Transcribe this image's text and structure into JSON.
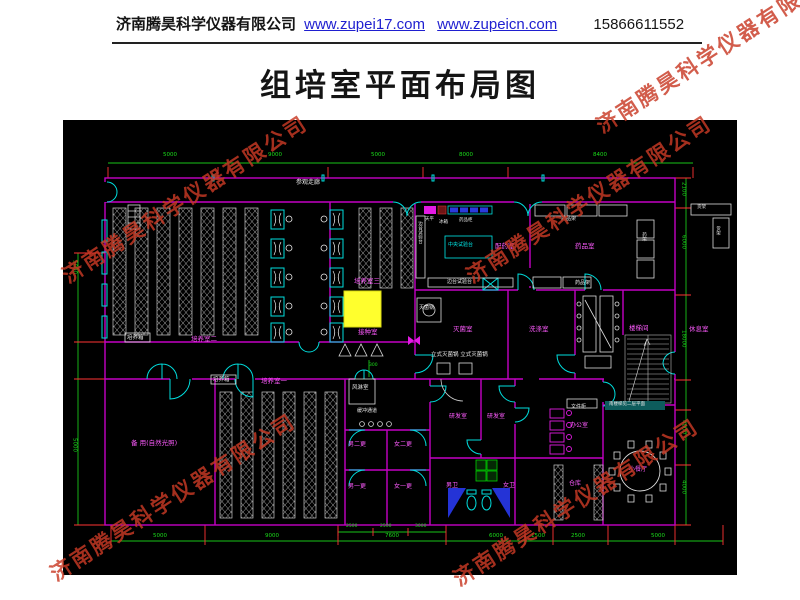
{
  "header": {
    "company": "济南腾昊科学仪器有限公司",
    "url1": "www.zupei17.com",
    "url2": "www.zupeicn.com",
    "phone": "15866611552"
  },
  "title": "组培室平面布局图",
  "watermark": {
    "text": "济南腾昊科学仪器有限公司"
  },
  "colors": {
    "wall": "#c400c4",
    "dimension": "#1ade1a",
    "tick": "#ff3333",
    "door": "#00dede",
    "highlight": "#ffff2d",
    "room_label": "#ff5bff",
    "equipment_label": "#e9e9e9",
    "watermark": "#c93a25",
    "link": "#1f1fd0"
  },
  "drawing": {
    "labels": [
      {
        "t": "参观走廊",
        "x": 233,
        "y": 60,
        "c": "w",
        "s": 6,
        "n": "label-visitor-corridor"
      },
      {
        "t": "培养箱",
        "x": 64,
        "y": 216,
        "c": "w",
        "s": 5.5,
        "n": "label-incubator"
      },
      {
        "t": "培养室二",
        "x": 128,
        "y": 216,
        "c": "m",
        "s": 6.5,
        "n": "label-culture-room-2"
      },
      {
        "t": "培养室三",
        "x": 291,
        "y": 158,
        "c": "m",
        "s": 6.5,
        "n": "label-culture-room-3"
      },
      {
        "t": "接种室",
        "x": 295,
        "y": 209,
        "c": "m",
        "s": 6.5,
        "n": "label-inoculation-room"
      },
      {
        "t": "培养箱",
        "x": 150,
        "y": 258,
        "c": "w",
        "s": 5.5,
        "n": "label-incubator"
      },
      {
        "t": "培养室一",
        "x": 198,
        "y": 258,
        "c": "m",
        "s": 6.5,
        "n": "label-culture-room-1"
      },
      {
        "t": "备 用(自然光照)",
        "x": 68,
        "y": 320,
        "c": "m",
        "s": 6.5,
        "n": "label-spare-room"
      },
      {
        "t": "风淋室",
        "x": 289,
        "y": 266,
        "c": "w",
        "s": 5.5,
        "n": "label-air-shower"
      },
      {
        "t": "缓冲通道",
        "x": 294,
        "y": 289,
        "c": "w",
        "s": 5,
        "n": "label-buffer-corridor"
      },
      {
        "t": "男二更",
        "x": 285,
        "y": 322,
        "c": "m",
        "s": 6,
        "n": "label-change-room"
      },
      {
        "t": "女二更",
        "x": 331,
        "y": 322,
        "c": "m",
        "s": 6,
        "n": "label-change-room"
      },
      {
        "t": "男一更",
        "x": 285,
        "y": 364,
        "c": "m",
        "s": 6,
        "n": "label-change-room"
      },
      {
        "t": "女一更",
        "x": 331,
        "y": 364,
        "c": "m",
        "s": 6,
        "n": "label-change-room"
      },
      {
        "t": "灭菌锅",
        "x": 356,
        "y": 186,
        "c": "w",
        "s": 5,
        "n": "label-sterilizer"
      },
      {
        "t": "灭菌室",
        "x": 390,
        "y": 206,
        "c": "m",
        "s": 6.5,
        "n": "label-sterilization-room"
      },
      {
        "t": "立式灭菌锅 立式灭菌锅",
        "x": 368,
        "y": 233,
        "c": "w",
        "s": 5.5,
        "n": "label-vertical-sterilizers"
      },
      {
        "t": "洗涤室",
        "x": 466,
        "y": 206,
        "c": "m",
        "s": 6.5,
        "n": "label-washing-room"
      },
      {
        "t": "配药室",
        "x": 432,
        "y": 123,
        "c": "m",
        "s": 6.5,
        "n": "label-medicine-prep-room"
      },
      {
        "t": "药品室",
        "x": 512,
        "y": 123,
        "c": "m",
        "s": 6.5,
        "n": "label-medicine-room"
      },
      {
        "t": "中央试验台",
        "x": 385,
        "y": 123,
        "c": "c",
        "s": 5,
        "n": "label-central-bench"
      },
      {
        "t": "边台试验台",
        "x": 354,
        "y": 101,
        "c": "w",
        "s": 4.5,
        "v": 1,
        "n": "label-side-bench"
      },
      {
        "t": "边台试验台",
        "x": 384,
        "y": 160,
        "c": "w",
        "s": 5,
        "n": "label-side-bench"
      },
      {
        "t": "天平",
        "x": 362,
        "y": 98,
        "c": "w",
        "s": 4.5,
        "n": "label-balance"
      },
      {
        "t": "冰箱",
        "x": 376,
        "y": 101,
        "c": "w",
        "s": 4.5,
        "n": "label-fridge"
      },
      {
        "t": "药品柜",
        "x": 396,
        "y": 99,
        "c": "w",
        "s": 4.5,
        "n": "label-medicine-cabinet"
      },
      {
        "t": "药品架",
        "x": 498,
        "y": 97,
        "c": "w",
        "s": 5,
        "n": "label-medicine-rack"
      },
      {
        "t": "药品架",
        "x": 512,
        "y": 161,
        "c": "w",
        "s": 5,
        "n": "label-medicine-rack"
      },
      {
        "t": "药架",
        "x": 578,
        "y": 112,
        "c": "w",
        "s": 4.5,
        "v": 1,
        "n": "label-rack"
      },
      {
        "t": "货架",
        "x": 634,
        "y": 86,
        "c": "w",
        "s": 4.5,
        "n": "label-shelf"
      },
      {
        "t": "货架",
        "x": 652,
        "y": 106,
        "c": "w",
        "s": 4.5,
        "v": 1,
        "n": "label-shelf"
      },
      {
        "t": "楼梯间",
        "x": 566,
        "y": 205,
        "c": "m",
        "s": 6.5,
        "n": "label-stairwell"
      },
      {
        "t": "休息室",
        "x": 626,
        "y": 206,
        "c": "m",
        "s": 6.5,
        "n": "label-rest-room"
      },
      {
        "t": "研发室",
        "x": 386,
        "y": 294,
        "c": "m",
        "s": 6,
        "n": "label-rd-room"
      },
      {
        "t": "研发室",
        "x": 424,
        "y": 294,
        "c": "m",
        "s": 6,
        "n": "label-rd-room"
      },
      {
        "t": "办公室",
        "x": 507,
        "y": 303,
        "c": "m",
        "s": 6,
        "n": "label-office"
      },
      {
        "t": "文件柜",
        "x": 508,
        "y": 285,
        "c": "w",
        "s": 5,
        "n": "label-file-cabinet"
      },
      {
        "t": "男卫",
        "x": 383,
        "y": 363,
        "c": "m",
        "s": 6,
        "n": "label-mens-toilet"
      },
      {
        "t": "女卫",
        "x": 440,
        "y": 363,
        "c": "m",
        "s": 6,
        "n": "label-womens-toilet"
      },
      {
        "t": "仓库",
        "x": 506,
        "y": 361,
        "c": "m",
        "s": 6,
        "n": "label-storage"
      },
      {
        "t": "小餐厅",
        "x": 566,
        "y": 347,
        "c": "m",
        "s": 6,
        "n": "label-dining-room"
      },
      {
        "t": "南楼梯见二层平面",
        "x": 546,
        "y": 283,
        "c": "w",
        "s": 4.5,
        "n": "label-stair-note"
      },
      {
        "t": "5000",
        "x": 100,
        "y": 33,
        "c": "g",
        "s": 5.5,
        "n": "dim-top"
      },
      {
        "t": "9000",
        "x": 205,
        "y": 33,
        "c": "g",
        "s": 5.5,
        "n": "dim-top"
      },
      {
        "t": "5000",
        "x": 308,
        "y": 33,
        "c": "g",
        "s": 5.5,
        "n": "dim-top"
      },
      {
        "t": "8000",
        "x": 396,
        "y": 33,
        "c": "g",
        "s": 5.5,
        "n": "dim-top"
      },
      {
        "t": "8400",
        "x": 530,
        "y": 33,
        "c": "g",
        "s": 5.5,
        "n": "dim-top"
      },
      {
        "t": "2100",
        "x": 617,
        "y": 62,
        "c": "g",
        "s": 5.5,
        "v": 1,
        "n": "dim-right"
      },
      {
        "t": "6000",
        "x": 617,
        "y": 115,
        "c": "g",
        "s": 5.5,
        "v": 1,
        "n": "dim-right"
      },
      {
        "t": "18000",
        "x": 617,
        "y": 210,
        "c": "g",
        "s": 5.5,
        "v": 1,
        "n": "dim-right"
      },
      {
        "t": "4000",
        "x": 617,
        "y": 300,
        "c": "g",
        "s": 5.5,
        "v": 1,
        "n": "dim-right"
      },
      {
        "t": "4000",
        "x": 617,
        "y": 360,
        "c": "g",
        "s": 5.5,
        "v": 1,
        "n": "dim-right"
      },
      {
        "t": "5000",
        "x": 8,
        "y": 140,
        "c": "g",
        "s": 5.5,
        "v": 1,
        "n": "dim-left"
      },
      {
        "t": "5000",
        "x": 8,
        "y": 318,
        "c": "g",
        "s": 5.5,
        "v": 1,
        "n": "dim-left"
      },
      {
        "t": "5000",
        "x": 90,
        "y": 414,
        "c": "g",
        "s": 5.5,
        "n": "dim-bottom"
      },
      {
        "t": "9000",
        "x": 202,
        "y": 414,
        "c": "g",
        "s": 5.5,
        "n": "dim-bottom"
      },
      {
        "t": "7600",
        "x": 322,
        "y": 414,
        "c": "g",
        "s": 5.5,
        "n": "dim-bottom"
      },
      {
        "t": "6000",
        "x": 426,
        "y": 414,
        "c": "g",
        "s": 5.5,
        "n": "dim-bottom"
      },
      {
        "t": "1500",
        "x": 468,
        "y": 414,
        "c": "g",
        "s": 5.5,
        "n": "dim-bottom"
      },
      {
        "t": "2500",
        "x": 508,
        "y": 414,
        "c": "g",
        "s": 5.5,
        "n": "dim-bottom"
      },
      {
        "t": "5000",
        "x": 588,
        "y": 414,
        "c": "g",
        "s": 5.5,
        "n": "dim-bottom"
      },
      {
        "t": "2500",
        "x": 283,
        "y": 405,
        "c": "g",
        "s": 4.5,
        "n": "dim-sub"
      },
      {
        "t": "2500",
        "x": 317,
        "y": 405,
        "c": "g",
        "s": 4.5,
        "n": "dim-sub"
      },
      {
        "t": "3000",
        "x": 352,
        "y": 405,
        "c": "g",
        "s": 4.5,
        "n": "dim-sub"
      },
      {
        "t": "300",
        "x": 306,
        "y": 244,
        "c": "g",
        "s": 4.5,
        "n": "dim-sub"
      }
    ]
  }
}
